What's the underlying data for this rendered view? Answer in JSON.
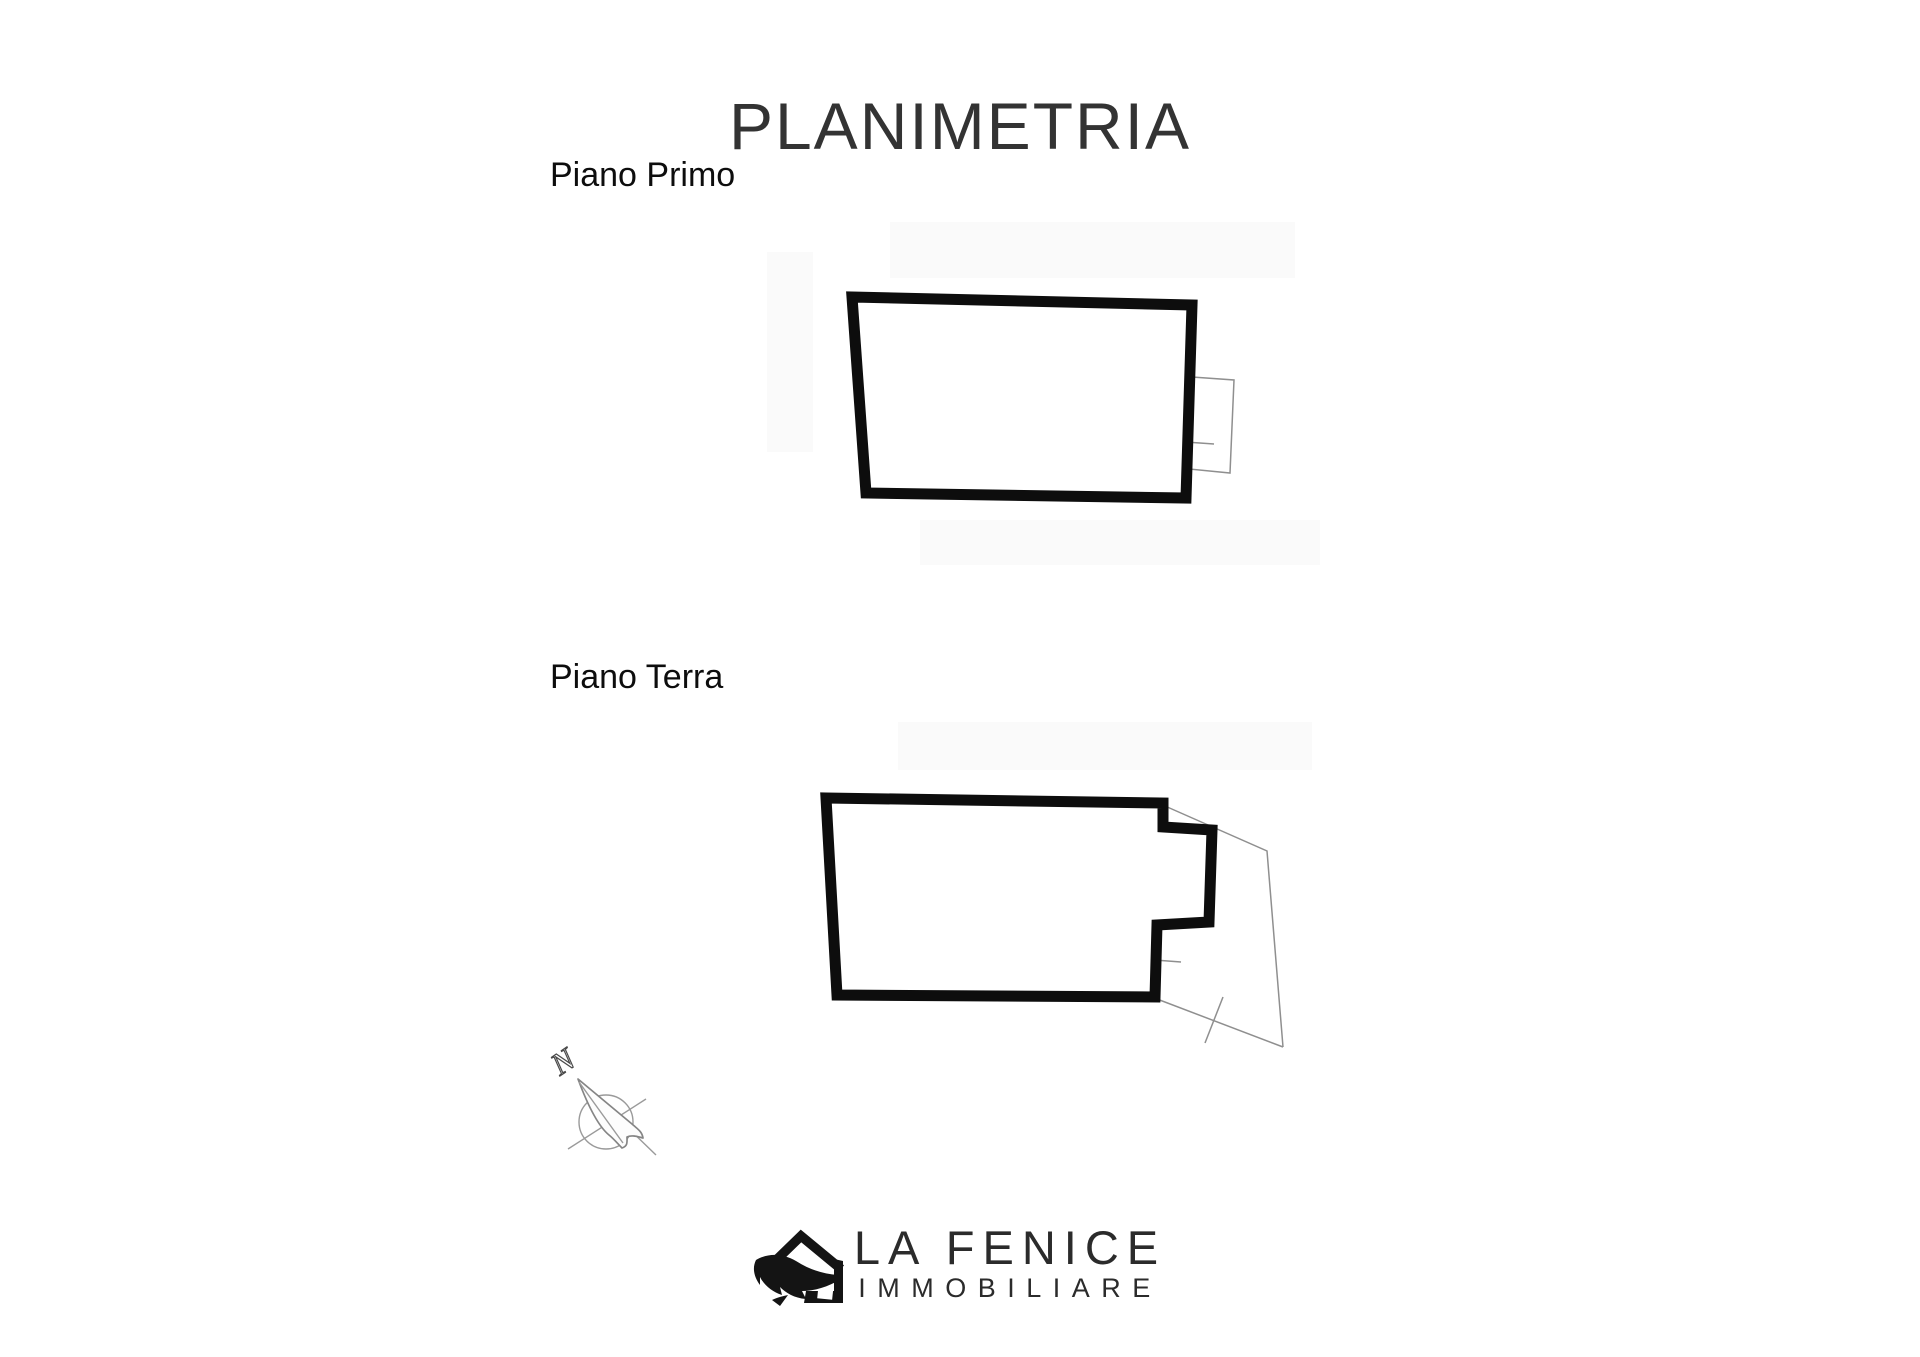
{
  "title": "PLANIMETRIA",
  "floors": [
    {
      "label": "Piano Primo"
    },
    {
      "label": "Piano Terra"
    }
  ],
  "compass": {
    "north_label": "N"
  },
  "logo": {
    "name": "LA FENICE",
    "subtitle": "IMMOBILIARE"
  },
  "colors": {
    "background": "#ffffff",
    "wall-line": "#0d0d0d",
    "thin-line": "#8f8f8f",
    "title-text": "#333333",
    "label-text": "#0d0d0d",
    "logo-text": "#2b2b2b",
    "scan-artifact": "#fafafa"
  }
}
